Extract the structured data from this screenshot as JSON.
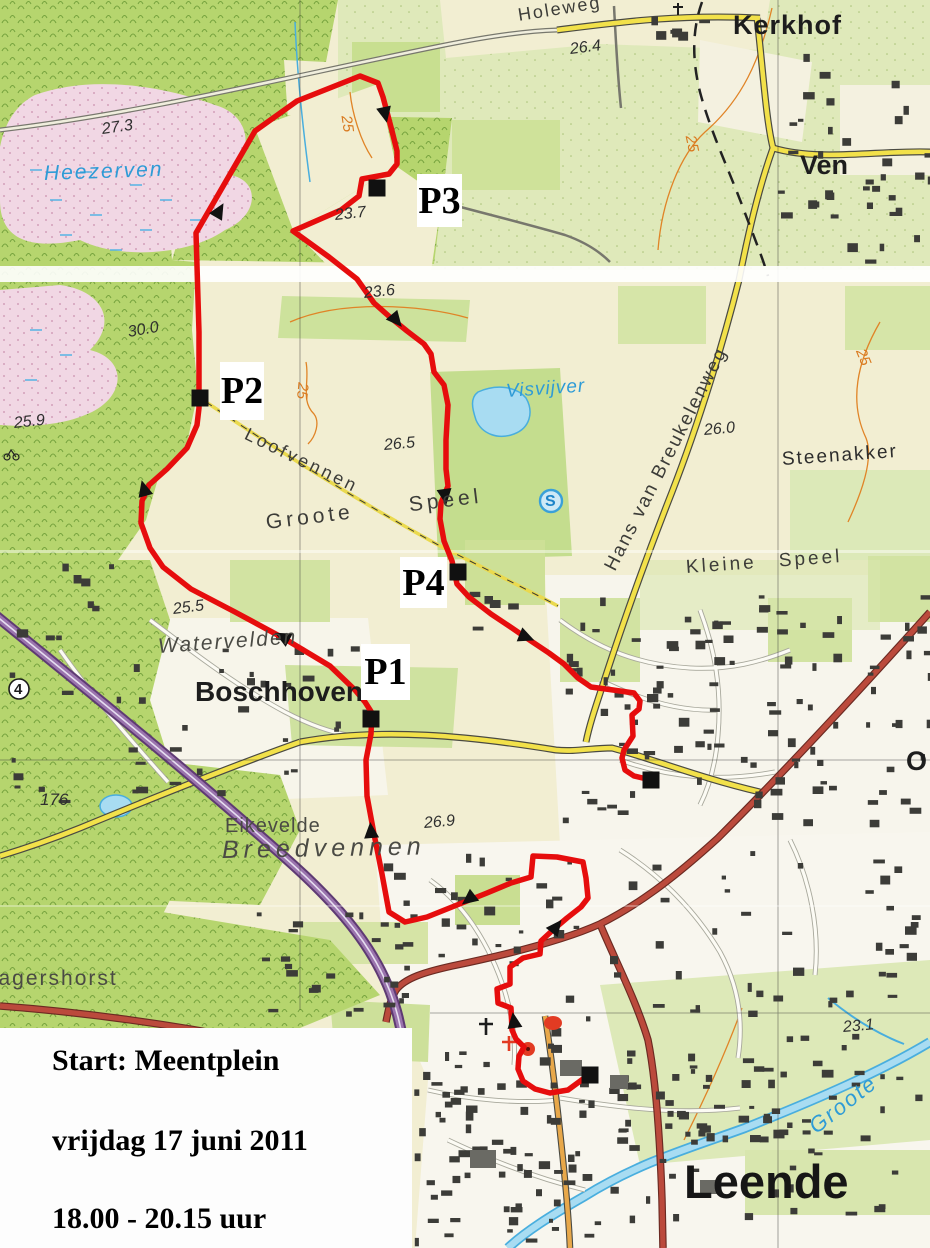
{
  "start_box": {
    "line1": "Start: Meentplein",
    "line2": "vrijdag 17 juni 2011",
    "line3": "18.00 - 20.15 uur"
  },
  "checkpoints": [
    {
      "label": "P1"
    },
    {
      "label": "P2"
    },
    {
      "label": "P3"
    },
    {
      "label": "P4"
    }
  ],
  "labels": {
    "holeweg": "Holeweg",
    "kerkhof": "Kerkhof",
    "ven": "Ven",
    "heezerven": "Heezerven",
    "visvijver": "Visvijver",
    "loofvennen": "Loofvennen",
    "groote_speel": "Groote Speel",
    "kleine_speel": "Kleine Speel",
    "hans_van_breukelenweg": "Hans van Breukelenweg",
    "steenakker": "Steenakker",
    "watervelden": "Watervelden",
    "boschhoven": "Boschhoven",
    "eikevelde": "Eikevelde",
    "breedvennen": "Breedvennen",
    "jagershorst": "Jagershorst",
    "leende": "Leende",
    "groote_aa": "Groote",
    "oostrik_partial": "O"
  },
  "symbols": {
    "road_number": "4",
    "s_circle": "S"
  },
  "elevations": {
    "h264": "26.4",
    "h273": "27.3",
    "h237": "23.7",
    "h236": "23.6",
    "h300": "30.0",
    "h259": "25.9",
    "h265": "26.5",
    "h260": "26.0",
    "h255": "25.5",
    "h269": "26.9",
    "h176": "176",
    "h231": "23.1"
  },
  "contour_label": "25",
  "colors": {
    "route": "#e60d0d",
    "marker": "#111111",
    "water": "#8fd2ec",
    "road_yellow": "#f2e14a",
    "motorway": "#7d4f91",
    "contour": "#e08427",
    "hydro_label": "#2e9bd6"
  }
}
